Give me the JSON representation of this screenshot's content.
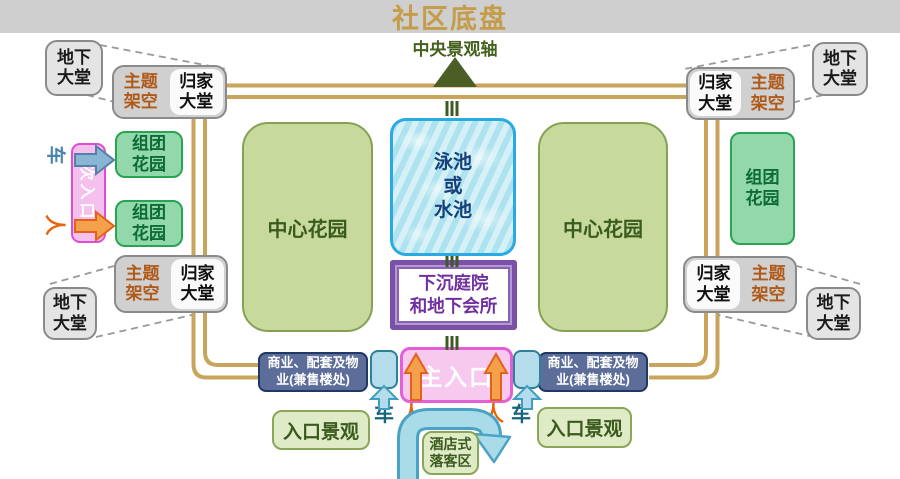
{
  "title": "社区底盘",
  "axis_label": "中央景观轴",
  "boxes": {
    "underground_lobby": "地下\n大堂",
    "theme_stilt": "主题\n架空",
    "home_lobby": "归家\n大堂",
    "cluster_garden": "组团\n花园",
    "central_garden": "中心花园",
    "pool": "泳池\n或\n水池",
    "sunken_courtyard": "下沉庭院\n和地下会所",
    "commerce": "商业、配套及物\n业(兼售楼处)",
    "main_entrance": "主入口",
    "entrance_landscape": "入口景观",
    "hotel_dropoff": "酒店式\n落客区",
    "secondary_entrance": "次入口"
  },
  "markers": {
    "car": "车",
    "person": "人"
  },
  "colors": {
    "title_gold": "#c59c4a",
    "road_tan": "#c9a45c",
    "axis_green": "#3e5a26",
    "pool_border": "#29abe2",
    "purple_frame": "#7a50a8",
    "entrance_magenta": "#e45fd5",
    "arrow_orange": "#f5a04a",
    "arrow_blue": "#aadbe9",
    "commerce_navy": "#5c6d9a",
    "garden_green": "#92d8aa",
    "lawn_olive": "#c7d99b"
  }
}
